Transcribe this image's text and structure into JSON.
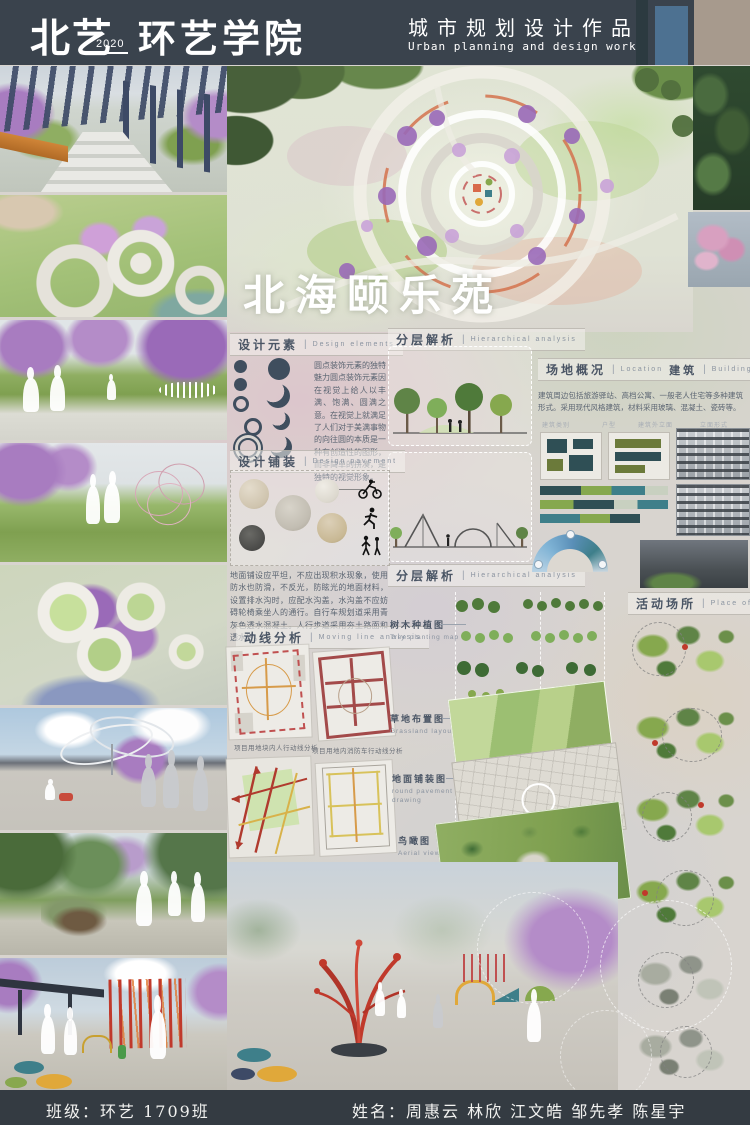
{
  "header": {
    "school_name": "北艺",
    "year": "2020",
    "college_name": "环艺学院",
    "work_title_cn": "城市规划设计作品",
    "work_title_en": "Urban planning and design works"
  },
  "hero": {
    "project_title": "北海颐乐苑"
  },
  "sections": {
    "design_elements": {
      "label_cn": "设计元素",
      "label_en": "Design elements",
      "body": "圆点装饰元素的独特魅力圆点装饰元素因在视觉上给人以丰满、饱满、圆满之意。在视觉上就满足了人们对于美满事物的向往圆的本质是一种有创造性的图形，而非简单的拼凑，是独特的视觉形象。"
    },
    "hierarchical_analysis": {
      "label_cn": "分层解析",
      "label_en": "Hierarchical analysis"
    },
    "site_overview": {
      "label_cn": "场地概况",
      "label_en": "Location",
      "label2_cn": "建筑",
      "label2_en": "Building",
      "body": "建筑周边包括旅游驿站、高档公寓、一般老人住宅等多种建筑形式。采用现代风格建筑，材料采用玻璃、混凝土、瓷砖等。",
      "sub_labels": [
        "建筑类别",
        "户型",
        "建筑外立面",
        "立面形式"
      ]
    },
    "design_pavement": {
      "label_cn": "设计铺装",
      "label_en": "Design pavement",
      "body": "地面铺设应平坦，不应出现积水现象，使用防水也防滑，不反光，防眩光的地面材料，设置排水沟时，应配水沟盖，水沟盖不应妨碍轮椅乘坐人的通行。自行车规划道采用青灰色透水混凝土。人行步道采用夯土路面和透水砖。"
    },
    "moving_line": {
      "label_cn": "动线分析",
      "label_en": "Moving line analysis",
      "captions": [
        "项目用地块内人行动线分析",
        "项目用地内消防车行动线分析",
        "项目用地外围车行动线分析",
        "项目用地内围车行动线分析"
      ]
    },
    "plans": [
      {
        "label_cn": "树木种植图",
        "label_en": "Tree planting map"
      },
      {
        "label_cn": "草地布置图",
        "label_en": "Grassland layout"
      },
      {
        "label_cn": "地面铺装图",
        "label_en": "round pavement drawing"
      },
      {
        "label_cn": "鸟瞰图",
        "label_en": "Aerial view"
      }
    ],
    "activity": {
      "label_cn": "活动场所",
      "label_en": "Place of activity"
    }
  },
  "footer": {
    "class_line": "班级：环艺  1709班",
    "names_line": "姓名：周惠云  林欣  江文皓  邹先孝  陈星宇"
  },
  "colors": {
    "header_bg": "#3a434d",
    "accent_slate": "#4a5565",
    "purple_tree": "#b48cc8",
    "lawn_green": "#9cbf72",
    "red_accent": "#c0392b"
  }
}
